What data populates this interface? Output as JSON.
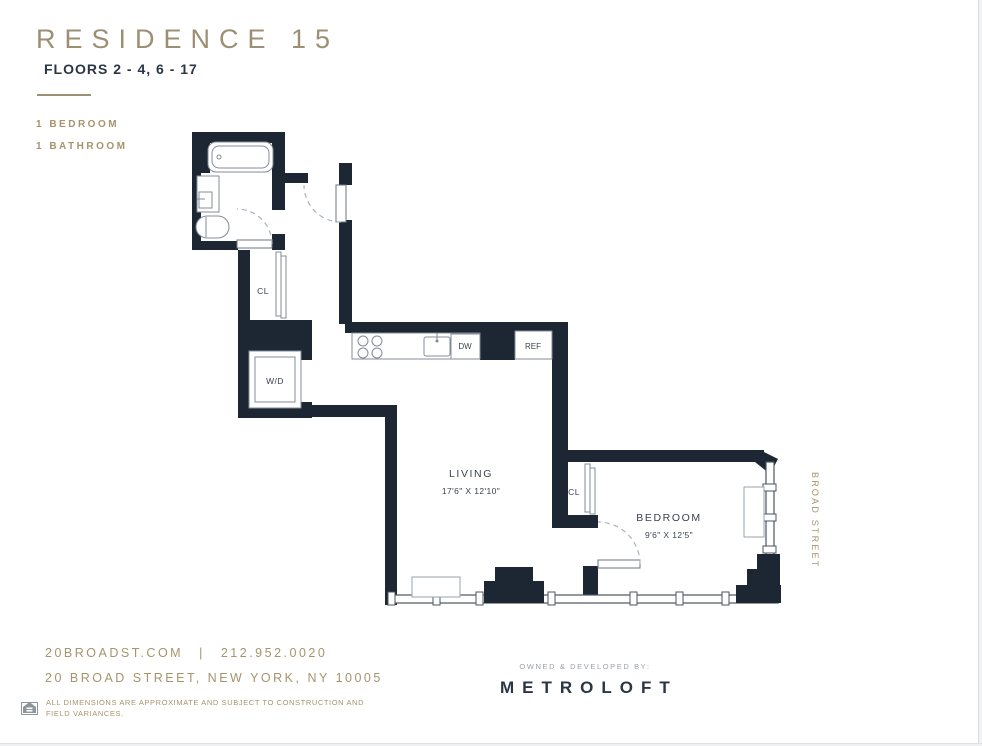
{
  "header": {
    "title": "RESIDENCE 15",
    "floors": "FLOORS 2 - 4, 6 - 17",
    "bedroom_count": "1 BEDROOM",
    "bathroom_count": "1 BATHROOM"
  },
  "plan": {
    "living": {
      "name": "LIVING",
      "dims": "17'6\" X 12'10\""
    },
    "bedroom": {
      "name": "BEDROOM",
      "dims": "9'6\" X 12'5\""
    },
    "closet_hall": "CL",
    "closet_bedroom": "CL",
    "washer_dryer": "W/D",
    "dishwasher": "DW",
    "refrigerator": "REF",
    "street": "BROAD STREET"
  },
  "footer": {
    "website": "20BROADST.COM",
    "separator": "|",
    "phone": "212.952.0020",
    "address": "20 BROAD STREET, NEW YORK, NY 10005",
    "disclaimer_line1": "ALL DIMENSIONS ARE APPROXIMATE AND SUBJECT TO CONSTRUCTION AND",
    "disclaimer_line2": "FIELD VARIANCES.",
    "developer_label": "OWNED & DEVELOPED BY:",
    "developer_name": "METROLOFT"
  },
  "colors": {
    "wall": "#1c2733",
    "gold": "#a6946c",
    "navy": "#2b3644"
  }
}
